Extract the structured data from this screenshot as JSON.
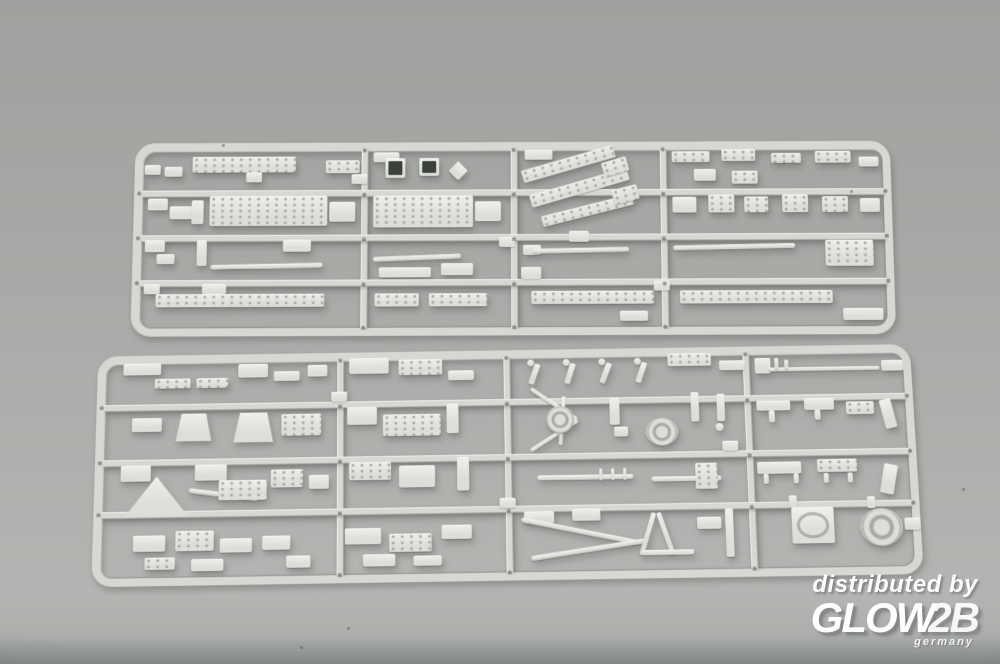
{
  "colors": {
    "bg_top": "#9fa19e",
    "bg_mid": "#a8aaa7",
    "bg_low": "#b3b5b2",
    "rail": "#d6d8d3",
    "part": "#dcded8",
    "part_dot": "#a6a8a1",
    "pin_dot": "#454945",
    "hole_dark": "#3c403d",
    "watermark": "#ffffff"
  },
  "watermark": {
    "line1": "distributed by",
    "logo_main": "GLOW",
    "logo_suffix": "2B",
    "logo_country": "germany"
  },
  "debris": [
    [
      347,
      627
    ],
    [
      222,
      144
    ],
    [
      850,
      190
    ],
    [
      962,
      488
    ],
    [
      300,
      646
    ]
  ],
  "sprues": [
    {
      "name": "sprue-top",
      "x": 133,
      "y": 141,
      "w": 760,
      "h": 194,
      "transform": "perspective(1100px) rotateX(5deg) rotate(-0.2deg)",
      "v_runners": [
        228,
        378,
        528
      ],
      "h_runners": [
        48,
        93,
        138
      ],
      "parts": [
        [
          10,
          22,
          16,
          10
        ],
        [
          30,
          24,
          18,
          10
        ],
        [
          58,
          14,
          104,
          16,
          "s"
        ],
        [
          112,
          30,
          16,
          10
        ],
        [
          192,
          18,
          34,
          13,
          "s"
        ],
        [
          14,
          56,
          20,
          12
        ],
        [
          36,
          64,
          24,
          13
        ],
        [
          58,
          58,
          12,
          24
        ],
        [
          76,
          54,
          118,
          30,
          "s"
        ],
        [
          196,
          60,
          26,
          20
        ],
        [
          12,
          98,
          20,
          12
        ],
        [
          24,
          112,
          18,
          10
        ],
        [
          64,
          98,
          10,
          26
        ],
        [
          150,
          98,
          28,
          12
        ],
        [
          78,
          122,
          112,
          5,
          "b",
          -1
        ],
        [
          12,
          142,
          16,
          10
        ],
        [
          70,
          142,
          24,
          10
        ],
        [
          24,
          152,
          168,
          13,
          "s"
        ],
        [
          218,
          32,
          16,
          10
        ],
        [
          240,
          10,
          26,
          10
        ],
        [
          252,
          16,
          20,
          20,
          "w"
        ],
        [
          286,
          16,
          20,
          18,
          "w"
        ],
        [
          318,
          22,
          14,
          14,
          "p",
          45
        ],
        [
          240,
          54,
          100,
          32,
          "s"
        ],
        [
          342,
          60,
          26,
          20
        ],
        [
          240,
          114,
          88,
          5,
          "b",
          -2
        ],
        [
          246,
          126,
          52,
          10
        ],
        [
          308,
          122,
          32,
          12
        ],
        [
          242,
          152,
          44,
          13,
          "s"
        ],
        [
          296,
          152,
          58,
          13,
          "s"
        ],
        [
          366,
          96,
          16,
          10
        ],
        [
          392,
          8,
          28,
          10
        ],
        [
          388,
          16,
          96,
          13,
          "s",
          -16
        ],
        [
          396,
          40,
          102,
          13,
          "s",
          -16
        ],
        [
          408,
          64,
          94,
          11,
          "s",
          -14
        ],
        [
          470,
          18,
          26,
          15,
          "s",
          -16
        ],
        [
          480,
          46,
          26,
          15,
          "s",
          -14
        ],
        [
          436,
          90,
          20,
          11
        ],
        [
          390,
          104,
          18,
          10
        ],
        [
          400,
          107,
          96,
          5,
          "b",
          -1
        ],
        [
          388,
          126,
          20,
          12
        ],
        [
          398,
          150,
          122,
          13,
          "s"
        ],
        [
          486,
          170,
          28,
          10
        ],
        [
          520,
          140,
          16,
          10
        ],
        [
          540,
          10,
          38,
          11,
          "s"
        ],
        [
          590,
          8,
          34,
          12,
          "s"
        ],
        [
          640,
          12,
          30,
          10,
          "s"
        ],
        [
          684,
          10,
          36,
          12,
          "s"
        ],
        [
          728,
          16,
          20,
          10
        ],
        [
          562,
          28,
          22,
          12
        ],
        [
          600,
          30,
          26,
          13,
          "s"
        ],
        [
          540,
          56,
          24,
          16
        ],
        [
          576,
          54,
          26,
          18,
          "s"
        ],
        [
          612,
          56,
          24,
          16,
          "s"
        ],
        [
          650,
          54,
          26,
          18,
          "s"
        ],
        [
          690,
          56,
          26,
          16,
          "s"
        ],
        [
          728,
          58,
          20,
          14
        ],
        [
          540,
          104,
          122,
          5,
          "b",
          -1
        ],
        [
          692,
          100,
          48,
          26,
          "s"
        ],
        [
          546,
          150,
          152,
          13,
          "s"
        ],
        [
          708,
          168,
          40,
          12
        ]
      ]
    },
    {
      "name": "sprue-bottom",
      "x": 95,
      "y": 348,
      "w": 822,
      "h": 232,
      "transform": "perspective(1100px) rotateX(7deg) rotate(-0.9deg)",
      "v_runners": [
        242,
        410,
        652
      ],
      "h_runners": [
        50,
        106,
        158
      ],
      "parts": [
        [
          26,
          8,
          38,
          12
        ],
        [
          58,
          24,
          36,
          10,
          "s"
        ],
        [
          100,
          24,
          32,
          10,
          "s"
        ],
        [
          142,
          10,
          30,
          14
        ],
        [
          178,
          18,
          26,
          10
        ],
        [
          212,
          12,
          20,
          12
        ],
        [
          36,
          64,
          30,
          14
        ],
        [
          80,
          60,
          36,
          28,
          "z"
        ],
        [
          138,
          60,
          40,
          30,
          "z"
        ],
        [
          186,
          62,
          40,
          22,
          "s"
        ],
        [
          26,
          112,
          30,
          16
        ],
        [
          30,
          122,
          64,
          42,
          "t"
        ],
        [
          94,
          140,
          70,
          5,
          "b",
          8
        ],
        [
          100,
          112,
          32,
          16
        ],
        [
          124,
          128,
          48,
          20,
          "s"
        ],
        [
          176,
          118,
          32,
          18,
          "s"
        ],
        [
          214,
          124,
          20,
          14
        ],
        [
          40,
          182,
          32,
          16
        ],
        [
          82,
          178,
          38,
          20,
          "s"
        ],
        [
          126,
          186,
          32,
          14
        ],
        [
          52,
          204,
          30,
          12,
          "s"
        ],
        [
          98,
          206,
          32,
          12
        ],
        [
          168,
          184,
          28,
          14
        ],
        [
          192,
          204,
          24,
          12
        ],
        [
          236,
          40,
          16,
          10
        ],
        [
          254,
          6,
          40,
          16
        ],
        [
          304,
          8,
          44,
          16,
          "s"
        ],
        [
          354,
          20,
          26,
          10
        ],
        [
          252,
          56,
          30,
          18
        ],
        [
          288,
          64,
          58,
          22,
          "s"
        ],
        [
          352,
          54,
          12,
          30
        ],
        [
          254,
          112,
          42,
          18,
          "s"
        ],
        [
          304,
          116,
          36,
          22
        ],
        [
          362,
          108,
          12,
          34
        ],
        [
          250,
          178,
          36,
          16
        ],
        [
          294,
          184,
          42,
          18,
          "s"
        ],
        [
          346,
          176,
          30,
          14
        ],
        [
          268,
          204,
          32,
          12
        ],
        [
          318,
          206,
          28,
          10
        ],
        [
          404,
          150,
          16,
          10
        ],
        [
          434,
          10,
          7,
          7,
          "c"
        ],
        [
          438,
          14,
          6,
          22,
          "p",
          20
        ],
        [
          470,
          10,
          7,
          7,
          "c"
        ],
        [
          474,
          14,
          6,
          22,
          "p",
          18
        ],
        [
          506,
          10,
          7,
          7,
          "c"
        ],
        [
          510,
          14,
          6,
          22,
          "p",
          22
        ],
        [
          542,
          10,
          7,
          7,
          "c"
        ],
        [
          546,
          14,
          6,
          22,
          "p",
          20
        ],
        [
          576,
          6,
          44,
          13,
          "s"
        ],
        [
          628,
          14,
          26,
          10
        ],
        [
          432,
          54,
          56,
          4,
          "p",
          35
        ],
        [
          432,
          86,
          56,
          4,
          "p",
          -32
        ],
        [
          466,
          48,
          4,
          50,
          "p",
          5
        ],
        [
          452,
          58,
          28,
          28,
          "r"
        ],
        [
          516,
          50,
          10,
          28
        ],
        [
          520,
          80,
          14,
          10
        ],
        [
          552,
          72,
          32,
          28,
          "r"
        ],
        [
          598,
          46,
          8,
          30
        ],
        [
          624,
          48,
          8,
          28
        ],
        [
          622,
          78,
          8,
          8,
          "c"
        ],
        [
          442,
          128,
          96,
          5,
          "b"
        ],
        [
          504,
          122,
          3,
          12
        ],
        [
          516,
          122,
          3,
          12
        ],
        [
          528,
          122,
          3,
          12
        ],
        [
          556,
          131,
          70,
          5,
          "b"
        ],
        [
          600,
          118,
          22,
          26,
          "s"
        ],
        [
          628,
          96,
          16,
          10
        ],
        [
          428,
          164,
          30,
          12
        ],
        [
          476,
          162,
          28,
          12
        ],
        [
          424,
          182,
          120,
          5,
          "b",
          12
        ],
        [
          434,
          200,
          118,
          5,
          "b",
          -8
        ],
        [
          548,
          166,
          5,
          44,
          "p",
          18
        ],
        [
          566,
          166,
          5,
          44,
          "p",
          -18
        ],
        [
          544,
          204,
          52,
          5
        ],
        [
          628,
          164,
          8,
          48
        ],
        [
          600,
          172,
          24,
          12
        ],
        [
          664,
          12,
          16,
          16
        ],
        [
          678,
          22,
          112,
          4,
          "b"
        ],
        [
          684,
          12,
          4,
          12
        ],
        [
          694,
          14,
          4,
          10
        ],
        [
          792,
          16,
          22,
          11
        ],
        [
          664,
          56,
          34,
          10
        ],
        [
          676,
          66,
          6,
          12
        ],
        [
          712,
          54,
          30,
          12
        ],
        [
          722,
          66,
          6,
          10
        ],
        [
          754,
          58,
          28,
          13,
          "s"
        ],
        [
          790,
          56,
          12,
          30,
          "p",
          -12
        ],
        [
          662,
          118,
          44,
          12
        ],
        [
          668,
          130,
          5,
          10
        ],
        [
          698,
          130,
          5,
          10
        ],
        [
          722,
          116,
          40,
          13,
          "s"
        ],
        [
          728,
          130,
          5,
          10
        ],
        [
          752,
          130,
          5,
          10
        ],
        [
          786,
          122,
          14,
          30,
          "p",
          12
        ],
        [
          692,
          152,
          8,
          12
        ],
        [
          694,
          164,
          42,
          36,
          "q"
        ],
        [
          770,
          154,
          8,
          12
        ],
        [
          762,
          166,
          42,
          38,
          "r"
        ],
        [
          806,
          176,
          16,
          12
        ]
      ]
    }
  ]
}
